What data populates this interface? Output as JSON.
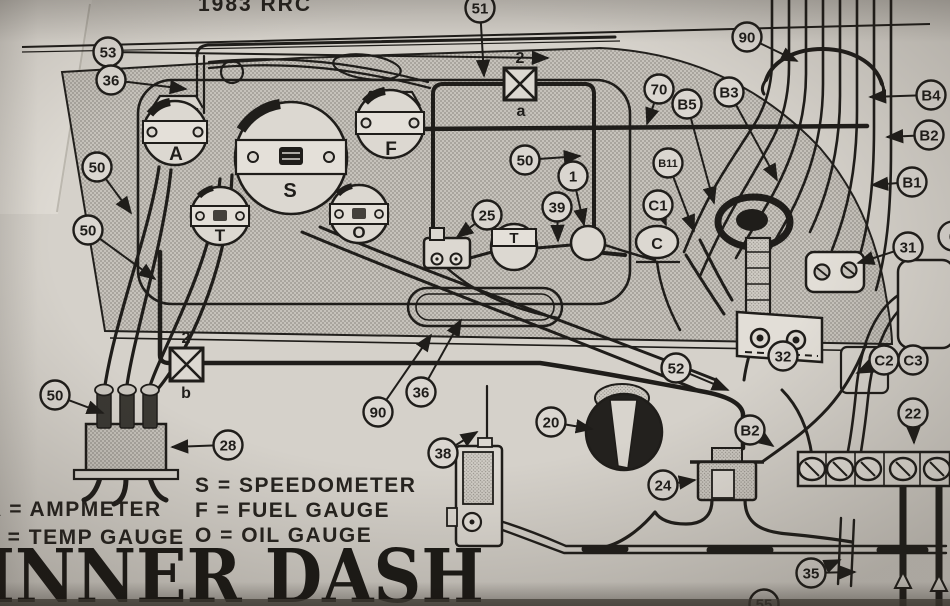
{
  "meta": {
    "top_text": "1983 RRC"
  },
  "title": {
    "text": "INNER DASH"
  },
  "legend": {
    "left": [
      "A = AMPMETER",
      "T = TEMP GAUGE"
    ],
    "right": [
      "S = SPEEDOMETER",
      "F = FUEL GAUGE",
      "O = OIL GAUGE"
    ]
  },
  "gauges": {
    "ammeter": "A",
    "speedometer": "S",
    "temp": "T",
    "fuel": "F",
    "oil": "O",
    "choke": "C",
    "sender": "T"
  },
  "fuses": {
    "a": {
      "top": "2",
      "bottom": "a"
    },
    "b": {
      "top": "2",
      "bottom": "b"
    }
  },
  "ink_color": "#1f1d1a",
  "paper_color": "#d5d1ca",
  "callouts": [
    {
      "label": "53",
      "x": 108,
      "y": 52,
      "tx": 548,
      "ty": 58
    },
    {
      "label": "36",
      "x": 111,
      "y": 80,
      "tx": 186,
      "ty": 89
    },
    {
      "label": "51",
      "x": 480,
      "y": 8,
      "tx": 484,
      "ty": 76
    },
    {
      "label": "90",
      "x": 747,
      "y": 37,
      "tx": 797,
      "ty": 61
    },
    {
      "label": "70",
      "x": 659,
      "y": 89,
      "tx": 647,
      "ty": 124
    },
    {
      "label": "B5",
      "x": 687,
      "y": 104,
      "tx": 714,
      "ty": 203
    },
    {
      "label": "B3",
      "x": 729,
      "y": 92,
      "tx": 777,
      "ty": 180
    },
    {
      "label": "B4",
      "x": 931,
      "y": 95,
      "tx": 870,
      "ty": 97
    },
    {
      "label": "B2",
      "x": 929,
      "y": 135,
      "tx": 887,
      "ty": 137
    },
    {
      "label": "B1",
      "x": 912,
      "y": 182,
      "tx": 872,
      "ty": 185
    },
    {
      "label": "B11",
      "x": 668,
      "y": 163,
      "tx": 694,
      "ty": 231
    },
    {
      "label": "C1",
      "x": 658,
      "y": 205,
      "tx": 666,
      "ty": 225
    },
    {
      "label": "6",
      "x": 953,
      "y": 236
    },
    {
      "label": "31",
      "x": 908,
      "y": 247,
      "tx": 858,
      "ty": 263
    },
    {
      "label": "32",
      "x": 783,
      "y": 356
    },
    {
      "label": "C2",
      "x": 884,
      "y": 360,
      "tx": 857,
      "ty": 373
    },
    {
      "label": "C3",
      "x": 913,
      "y": 360
    },
    {
      "label": "22",
      "x": 913,
      "y": 413,
      "tx": 914,
      "ty": 443
    },
    {
      "label": "52",
      "x": 676,
      "y": 368,
      "tx": 728,
      "ty": 390
    },
    {
      "label": "B2",
      "x": 750,
      "y": 430,
      "tx": 773,
      "ty": 446
    },
    {
      "label": "24",
      "x": 663,
      "y": 485,
      "tx": 695,
      "ty": 480
    },
    {
      "label": "35",
      "x": 811,
      "y": 573,
      "tx": 840,
      "ty": 560,
      "tx2": 855,
      "ty2": 572
    },
    {
      "label": "55",
      "x": 764,
      "y": 604
    },
    {
      "label": "20",
      "x": 551,
      "y": 422,
      "tx": 592,
      "ty": 429
    },
    {
      "label": "38",
      "x": 443,
      "y": 453,
      "tx": 477,
      "ty": 432
    },
    {
      "label": "90",
      "x": 378,
      "y": 412,
      "tx": 431,
      "ty": 335
    },
    {
      "label": "36",
      "x": 421,
      "y": 392,
      "tx": 461,
      "ty": 320
    },
    {
      "label": "28",
      "x": 228,
      "y": 445,
      "tx": 172,
      "ty": 447
    },
    {
      "label": "50",
      "x": 55,
      "y": 395,
      "tx": 103,
      "ty": 413
    },
    {
      "label": "50",
      "x": 97,
      "y": 167,
      "tx": 131,
      "ty": 213
    },
    {
      "label": "50",
      "x": 88,
      "y": 230,
      "tx": 155,
      "ty": 279
    },
    {
      "label": "50",
      "x": 525,
      "y": 160,
      "tx": 580,
      "ty": 156
    },
    {
      "label": "25",
      "x": 487,
      "y": 215,
      "tx": 457,
      "ty": 237
    },
    {
      "label": "39",
      "x": 557,
      "y": 207,
      "tx": 558,
      "ty": 241
    },
    {
      "label": "1",
      "x": 573,
      "y": 176,
      "tx": 584,
      "ty": 225
    }
  ]
}
